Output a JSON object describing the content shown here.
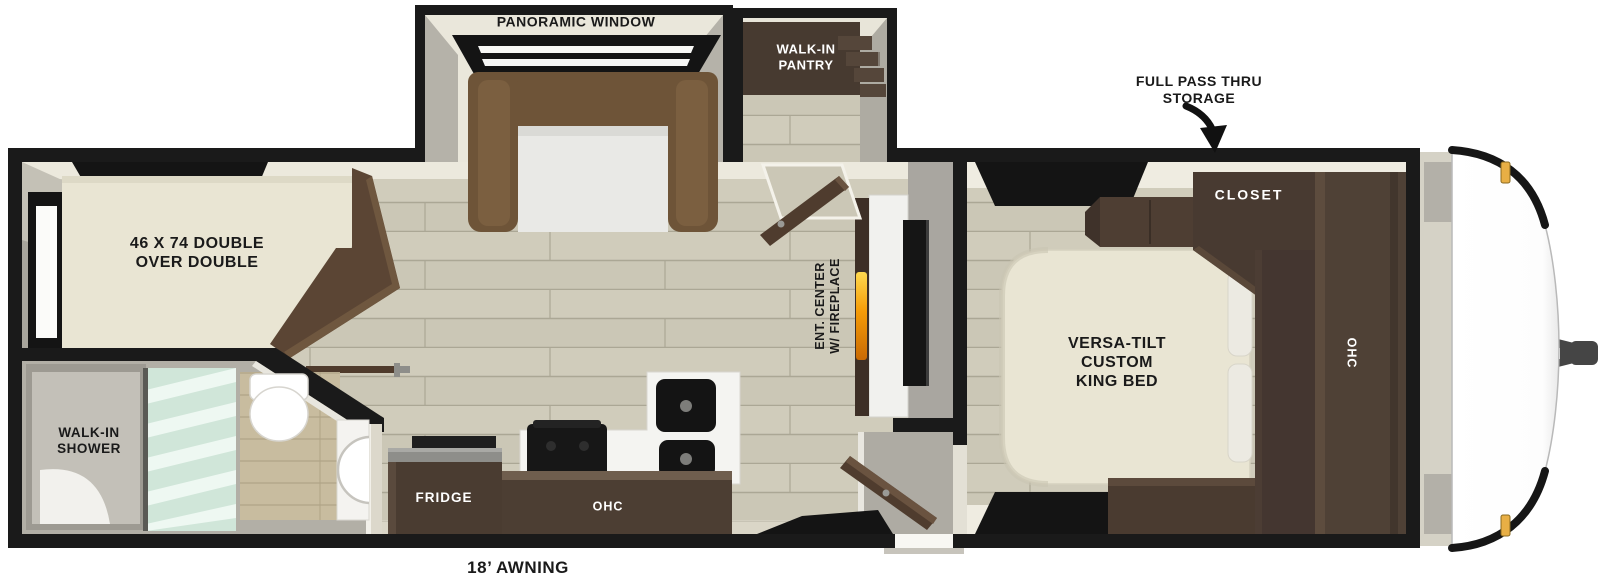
{
  "floorplan": {
    "type": "travel-trailer-floorplan",
    "labels": {
      "panoramic_window": "PANORAMIC WINDOW",
      "walk_in_pantry": "WALK-IN\nPANTRY",
      "full_pass_thru_storage": "FULL PASS THRU\nSTORAGE",
      "bunk_bed": "46 X 74 DOUBLE\nOVER DOUBLE",
      "ent_center": "ENT. CENTER\nW/ FIREPLACE",
      "closet": "CLOSET",
      "bedroom_ohc": "OHC",
      "king_bed": "VERSA-TILT\nCUSTOM\nKING BED",
      "walk_in_shower": "WALK-IN\nSHOWER",
      "fridge": "FRIDGE",
      "kitchen_ohc": "OHC",
      "awning": "18’ AWNING"
    },
    "colors": {
      "wall": "#1a1a1a",
      "floor": "#cbc7b6",
      "wall_face_cream": "#ece9dd",
      "cabinet_dark": "#4a3c31",
      "sofa_brown": "#6e5438",
      "mattress_cream": "#e9e5d3",
      "bath_floor_gray": "#b2afa6",
      "shower_glass": "#d3eadd",
      "tan_wall_planks": "#c8bc9f",
      "flame_orange": "#f59b07",
      "marker_light_amber": "#e8af45",
      "label_dark": "#1a1a1a",
      "label_light": "#ffffff"
    }
  }
}
